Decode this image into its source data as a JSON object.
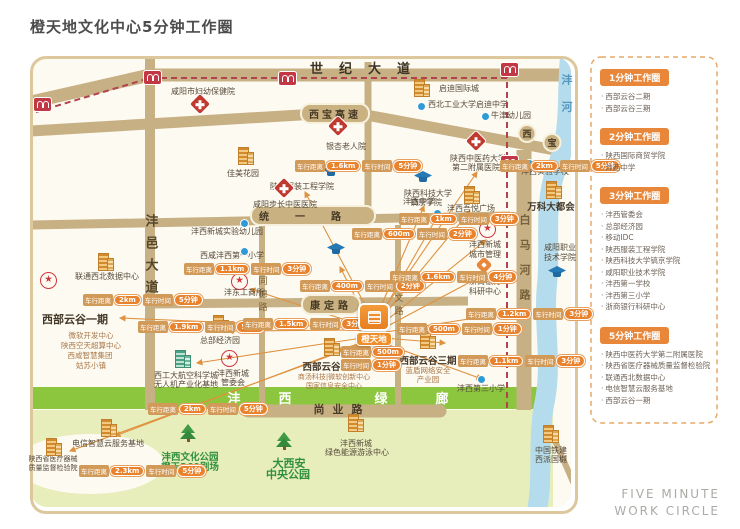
{
  "title": "橙天地文化中心5分钟工作圈",
  "footer": {
    "line1": "FIVE MINUTE",
    "line2": "WORK CIRCLE"
  },
  "colors": {
    "accent_orange": "#e8873a",
    "badge_value": "#e8822d",
    "road_tan": "#c7b084",
    "river_blue": "#b5dcec",
    "corridor_green": "#8cc63e",
    "metro_red": "#b2424e"
  },
  "glyphs": {
    "star": "★"
  },
  "legend": {
    "sections": [
      {
        "title": "1分钟工作圈",
        "items": [
          "西部云谷二期",
          "西部云谷三期"
        ]
      },
      {
        "title": "2分钟工作圈",
        "items": [
          "陕西国际商贸学院",
          "沣西中学"
        ]
      },
      {
        "title": "3分钟工作圈",
        "items": [
          "沣西管委会",
          "总部经济园",
          "移动IDC",
          "陕西服装工程学院",
          "陕西科技大学镐京学院",
          "咸阳职业技术学院",
          "沣西第一学校",
          "沣西第三小学",
          "浙商银行科研中心"
        ]
      },
      {
        "title": "5分钟工作圈",
        "items": [
          "陕西中医药大学第二附属医院",
          "陕西省医疗器械质量监督检验院",
          "联通西北数据中心",
          "电信智慧云服务基地",
          "西部云谷一期"
        ]
      }
    ]
  },
  "map": {
    "marker": {
      "label": "橙天地",
      "x": 356,
      "y": 303
    },
    "badge_labels": {
      "distance": "车行距离",
      "time": "车行时间"
    },
    "badges": [
      {
        "d": "2km",
        "t": "5分钟",
        "x": 83,
        "y": 294
      },
      {
        "d": "1.9km",
        "t": "5分钟",
        "x": 138,
        "y": 321
      },
      {
        "d": "1.1km",
        "t": "3分钟",
        "x": 184,
        "y": 263
      },
      {
        "d": "1.6km",
        "t": "5分钟",
        "x": 295,
        "y": 160
      },
      {
        "d": "2km",
        "t": "5分钟",
        "x": 500,
        "y": 160
      },
      {
        "d": "1km",
        "t": "3分钟",
        "x": 399,
        "y": 213
      },
      {
        "d": "600m",
        "t": "2分钟",
        "x": 352,
        "y": 228
      },
      {
        "d": "400m",
        "t": "2分钟",
        "x": 300,
        "y": 280
      },
      {
        "d": "1.6km",
        "t": "4分钟",
        "x": 390,
        "y": 271
      },
      {
        "d": "1.2km",
        "t": "3分钟",
        "x": 466,
        "y": 308
      },
      {
        "d": "500m",
        "t": "1分钟",
        "x": 397,
        "y": 323
      },
      {
        "d": "1.1km",
        "t": "3分钟",
        "x": 458,
        "y": 355
      },
      {
        "d": "500m",
        "t": "1分钟",
        "x": 341,
        "y": 346,
        "two": true
      },
      {
        "d": "1.5km",
        "t": "3分钟",
        "x": 243,
        "y": 318
      },
      {
        "d": "2.3km",
        "t": "5分钟",
        "x": 79,
        "y": 465
      },
      {
        "d": "2km",
        "t": "5分钟",
        "x": 148,
        "y": 403
      }
    ],
    "icons": [
      {
        "t": "hospital",
        "x": 192,
        "y": 96
      },
      {
        "t": "hospital",
        "x": 330,
        "y": 118
      },
      {
        "t": "hospital",
        "x": 468,
        "y": 133
      },
      {
        "t": "hospital",
        "x": 276,
        "y": 180
      },
      {
        "t": "dot",
        "x": 417,
        "y": 102
      },
      {
        "t": "dot",
        "x": 481,
        "y": 112
      },
      {
        "t": "dot",
        "x": 525,
        "y": 159
      },
      {
        "t": "dot",
        "x": 433,
        "y": 209
      },
      {
        "t": "dot",
        "x": 240,
        "y": 219
      },
      {
        "t": "dot",
        "x": 240,
        "y": 247
      },
      {
        "t": "dot",
        "x": 477,
        "y": 375
      },
      {
        "t": "cap",
        "x": 322,
        "y": 165
      },
      {
        "t": "cap",
        "x": 414,
        "y": 171
      },
      {
        "t": "cap",
        "x": 327,
        "y": 243
      },
      {
        "t": "cap",
        "x": 548,
        "y": 266
      },
      {
        "t": "star",
        "x": 40,
        "y": 272
      },
      {
        "t": "star",
        "x": 231,
        "y": 273
      },
      {
        "t": "star",
        "x": 221,
        "y": 350
      },
      {
        "t": "star",
        "x": 479,
        "y": 221
      },
      {
        "t": "bank",
        "x": 478,
        "y": 259
      },
      {
        "t": "bld",
        "x": 412,
        "y": 79
      },
      {
        "t": "bld",
        "x": 236,
        "y": 147
      },
      {
        "t": "bld",
        "x": 544,
        "y": 181
      },
      {
        "t": "bld",
        "x": 462,
        "y": 186
      },
      {
        "t": "bld",
        "x": 96,
        "y": 253
      },
      {
        "t": "bld",
        "x": 211,
        "y": 315
      },
      {
        "t": "bld",
        "x": 322,
        "y": 338
      },
      {
        "t": "bld",
        "x": 418,
        "y": 331
      },
      {
        "t": "bld",
        "x": 99,
        "y": 419
      },
      {
        "t": "bld",
        "x": 44,
        "y": 438
      },
      {
        "t": "bld",
        "x": 541,
        "y": 425
      },
      {
        "t": "bld",
        "x": 346,
        "y": 414
      },
      {
        "t": "bldg-green",
        "x": 173,
        "y": 350
      },
      {
        "t": "tree",
        "x": 180,
        "y": 424
      },
      {
        "t": "tree",
        "x": 276,
        "y": 432
      },
      {
        "t": "metro",
        "x": 33,
        "y": 97
      },
      {
        "t": "metro",
        "x": 143,
        "y": 70
      },
      {
        "t": "metro",
        "x": 278,
        "y": 71
      },
      {
        "t": "metro",
        "x": 500,
        "y": 62
      },
      {
        "t": "metro",
        "x": 500,
        "y": 155
      }
    ],
    "labels": [
      {
        "text": "世纪大道",
        "x": 368,
        "y": 58,
        "cls": "rd lg",
        "ls": 16
      },
      {
        "text": "西宝高速",
        "x": 335,
        "y": 103,
        "cls": "cap-pill",
        "ls": 3
      },
      {
        "text": "西",
        "x": 527,
        "y": 124,
        "cls": "circ"
      },
      {
        "text": "宝",
        "x": 552,
        "y": 133,
        "cls": "circ"
      },
      {
        "text": "统一路",
        "x": 313,
        "y": 205,
        "cls": "cap-pill",
        "ls": 26
      },
      {
        "text": "康定路",
        "x": 331,
        "y": 294,
        "cls": "cap-pill",
        "ls": 4
      },
      {
        "text": "尚业路",
        "x": 342,
        "y": 401,
        "cls": "rd",
        "ls": 8
      },
      {
        "text": "沣邑大道",
        "x": 150,
        "y": 214,
        "cls": "vrd",
        "ls": 9
      },
      {
        "text": "同德路",
        "x": 262,
        "y": 276,
        "cls": "vrd sm",
        "ls": 4
      },
      {
        "text": "同文路",
        "x": 398,
        "y": 280,
        "cls": "vrd sm",
        "ls": 4
      },
      {
        "text": "白马河路",
        "x": 524,
        "y": 214,
        "cls": "vrd md",
        "ls": 14
      },
      {
        "text": "沣河",
        "x": 566,
        "y": 74,
        "cls": "vriver",
        "ls": 16
      },
      {
        "text": "沣",
        "x": 234,
        "y": 388,
        "cls": "gc"
      },
      {
        "text": "西",
        "x": 285,
        "y": 388,
        "cls": "gc"
      },
      {
        "text": "绿",
        "x": 381,
        "y": 388,
        "cls": "gc"
      },
      {
        "text": "廊",
        "x": 442,
        "y": 388,
        "cls": "gc"
      },
      {
        "text": "咸阳市妇幼保健院",
        "x": 203,
        "y": 86,
        "cls": "p"
      },
      {
        "text": "启迪国际城",
        "x": 459,
        "y": 83,
        "cls": "p"
      },
      {
        "text": "西北工业大学启迪中学",
        "x": 468,
        "y": 99,
        "cls": "p"
      },
      {
        "text": "牛津幼儿园",
        "x": 511,
        "y": 110,
        "cls": "p"
      },
      {
        "text": "银杏老人院",
        "x": 346,
        "y": 141,
        "cls": "p"
      },
      {
        "text": "陕西中医药大学",
        "x": 478,
        "y": 153,
        "cls": "p"
      },
      {
        "text": "第二附属医院",
        "x": 476,
        "y": 162,
        "cls": "p"
      },
      {
        "text": "沣西实验学校",
        "x": 545,
        "y": 166,
        "cls": "p"
      },
      {
        "text": "万科大都会",
        "x": 551,
        "y": 199,
        "cls": "pb"
      },
      {
        "text": "佳美花园",
        "x": 243,
        "y": 168,
        "cls": "p"
      },
      {
        "text": "咸阳步长中医医院",
        "x": 285,
        "y": 199,
        "cls": "p"
      },
      {
        "text": "陕西服装工程学院",
        "x": 302,
        "y": 181,
        "cls": "p"
      },
      {
        "text": "沣西中学",
        "x": 419,
        "y": 196,
        "cls": "p"
      },
      {
        "text": "陕西科技大学",
        "x": 428,
        "y": 188,
        "cls": "p"
      },
      {
        "text": "镐京学院",
        "x": 426,
        "y": 197,
        "cls": "p"
      },
      {
        "text": "沣西吾悦广场",
        "x": 471,
        "y": 203,
        "cls": "p"
      },
      {
        "text": "沣西新城实验幼儿园",
        "x": 227,
        "y": 226,
        "cls": "p"
      },
      {
        "text": "西咸沣西第一小学",
        "x": 232,
        "y": 250,
        "cls": "p"
      },
      {
        "text": "沣东工商所",
        "x": 244,
        "y": 287,
        "cls": "p"
      },
      {
        "text": "联通西北数据中心",
        "x": 107,
        "y": 271,
        "cls": "p"
      },
      {
        "text": "西部云谷一期",
        "x": 75,
        "y": 311,
        "cls": "pb lg2"
      },
      {
        "text": "微软开发中心",
        "x": 91,
        "y": 330,
        "cls": "sub"
      },
      {
        "text": "陕西空天超算中心",
        "x": 91,
        "y": 340,
        "cls": "sub"
      },
      {
        "text": "西咸智慧集团",
        "x": 90,
        "y": 350,
        "cls": "sub"
      },
      {
        "text": "姑苏小镇",
        "x": 91,
        "y": 360,
        "cls": "sub"
      },
      {
        "text": "总部经济园",
        "x": 220,
        "y": 335,
        "cls": "p"
      },
      {
        "text": "西工大航空科学城",
        "x": 186,
        "y": 370,
        "cls": "p"
      },
      {
        "text": "无人机产业化基地",
        "x": 186,
        "y": 379,
        "cls": "p"
      },
      {
        "text": "沣西新城",
        "x": 233,
        "y": 368,
        "cls": "p"
      },
      {
        "text": "管委会",
        "x": 233,
        "y": 377,
        "cls": "p"
      },
      {
        "text": "沣西新城",
        "x": 485,
        "y": 239,
        "cls": "p"
      },
      {
        "text": "城市管理",
        "x": 485,
        "y": 249,
        "cls": "p"
      },
      {
        "text": "浙商银行",
        "x": 485,
        "y": 276,
        "cls": "p"
      },
      {
        "text": "科研中心",
        "x": 485,
        "y": 286,
        "cls": "p"
      },
      {
        "text": "咸阳职业",
        "x": 560,
        "y": 242,
        "cls": "p"
      },
      {
        "text": "技术学院",
        "x": 560,
        "y": 252,
        "cls": "p"
      },
      {
        "text": "西部云谷二期",
        "x": 331,
        "y": 359,
        "cls": "pb"
      },
      {
        "text": "商汤科技|微软创新中心",
        "x": 334,
        "y": 372,
        "cls": "sub s"
      },
      {
        "text": "国家信息安全中心",
        "x": 334,
        "y": 381,
        "cls": "sub s"
      },
      {
        "text": "西部云谷三期",
        "x": 428,
        "y": 353,
        "cls": "pb"
      },
      {
        "text": "蓝盾网络安全",
        "x": 428,
        "y": 365,
        "cls": "sub"
      },
      {
        "text": "产业园",
        "x": 428,
        "y": 374,
        "cls": "sub"
      },
      {
        "text": "沣西第三小学",
        "x": 481,
        "y": 383,
        "cls": "p"
      },
      {
        "text": "电信智慧云服务基地",
        "x": 108,
        "y": 438,
        "cls": "p"
      },
      {
        "text": "陕西省医疗器械",
        "x": 53,
        "y": 454,
        "cls": "p s"
      },
      {
        "text": "质量监督检验院",
        "x": 53,
        "y": 463,
        "cls": "p s"
      },
      {
        "text": "中国铁建",
        "x": 551,
        "y": 445,
        "cls": "p"
      },
      {
        "text": "西派国樾",
        "x": 551,
        "y": 454,
        "cls": "p"
      },
      {
        "text": "沣西文化公园",
        "x": 190,
        "y": 449,
        "cls": "park"
      },
      {
        "text": "橙天360剧场",
        "x": 190,
        "y": 459,
        "cls": "park"
      },
      {
        "text": "大西安",
        "x": 289,
        "y": 455,
        "cls": "park lg3"
      },
      {
        "text": "中央公园",
        "x": 288,
        "y": 466,
        "cls": "park lg3"
      },
      {
        "text": "沣西新城",
        "x": 356,
        "y": 438,
        "cls": "p"
      },
      {
        "text": "绿色能源游泳中心",
        "x": 357,
        "y": 447,
        "cls": "p"
      }
    ]
  }
}
